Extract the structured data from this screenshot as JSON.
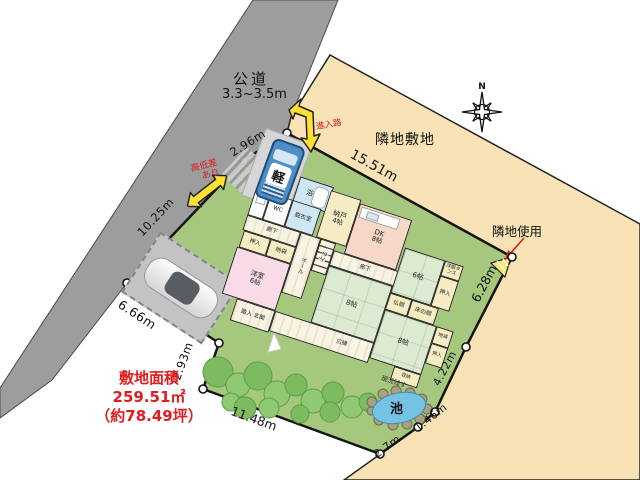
{
  "road": {
    "name": "公道",
    "width": "3.3~3.5m"
  },
  "neighbor": {
    "land_label": "隣地敷地",
    "use_label": "隣地使用"
  },
  "site": {
    "area_title": "敷地面積",
    "area_m2": "259.51㎡",
    "area_tsubo": "（約78.49坪）"
  },
  "compass": {
    "north": "N"
  },
  "annotations": {
    "approach_road": "進入路",
    "height_gap_line1": "高低差",
    "height_gap_line2": "あり",
    "kei_car": "軽",
    "pond": "池",
    "keep_current": "現況残す"
  },
  "measurements": {
    "top_entry": "2.96m",
    "road_side": "10.25m",
    "north_edge": "15.51m",
    "parking_edge": "6.66m",
    "west_edge": "2.93m",
    "south_edge": "11.48m",
    "south_corner": "2.7m",
    "southeast_small": "1.46m",
    "southeast": "4.22m",
    "east_edge": "6.28m"
  },
  "rooms": {
    "bath": {
      "name": "浴室",
      "size": ""
    },
    "dressing": {
      "name": "脱衣室",
      "size": ""
    },
    "wc": {
      "name": "WC",
      "size": ""
    },
    "nando": {
      "name": "納戸",
      "size": "4帖"
    },
    "dk": {
      "name": "DK",
      "size": "8帖"
    },
    "corridor_west": {
      "name": "廊下",
      "size": ""
    },
    "oshiire_west": {
      "name": "押入",
      "size": ""
    },
    "jibukuro_west": {
      "name": "地袋",
      "size": ""
    },
    "western": {
      "name": "洋室",
      "size": "6帖"
    },
    "hall": {
      "name": "ホール",
      "size": ""
    },
    "stairs": {
      "name": "上る",
      "size": ""
    },
    "corridor_east": {
      "name": "廊下",
      "size": ""
    },
    "tatami6": {
      "name": "6帖",
      "size": ""
    },
    "tansu": {
      "name": "洋服タンス",
      "size": ""
    },
    "oshiire_east": {
      "name": "押入",
      "size": ""
    },
    "butsuma": {
      "name": "仏間",
      "size": ""
    },
    "tokonoma": {
      "name": "床の間",
      "size": ""
    },
    "tatami8_mid": {
      "name": "8帖",
      "size": ""
    },
    "tatami8_se": {
      "name": "8帖",
      "size": ""
    },
    "jibukuro_east": {
      "name": "地袋",
      "size": ""
    },
    "oshiire_se": {
      "name": "押入",
      "size": ""
    },
    "shuno": {
      "name": "収納",
      "size": ""
    },
    "hiroen": {
      "name": "広縁",
      "size": ""
    },
    "genkan": {
      "name": "踏入 玄関",
      "size": ""
    }
  },
  "colors": {
    "road": "#9d9d9d",
    "neighbor_land": "#f8e2b6",
    "grass": "#a5c77e",
    "tatami": "#dcead2",
    "pond": "#74c2e4",
    "arrow_yellow": "#ffe134",
    "alert_red": "#e01c1c",
    "boundary": "#141414"
  }
}
